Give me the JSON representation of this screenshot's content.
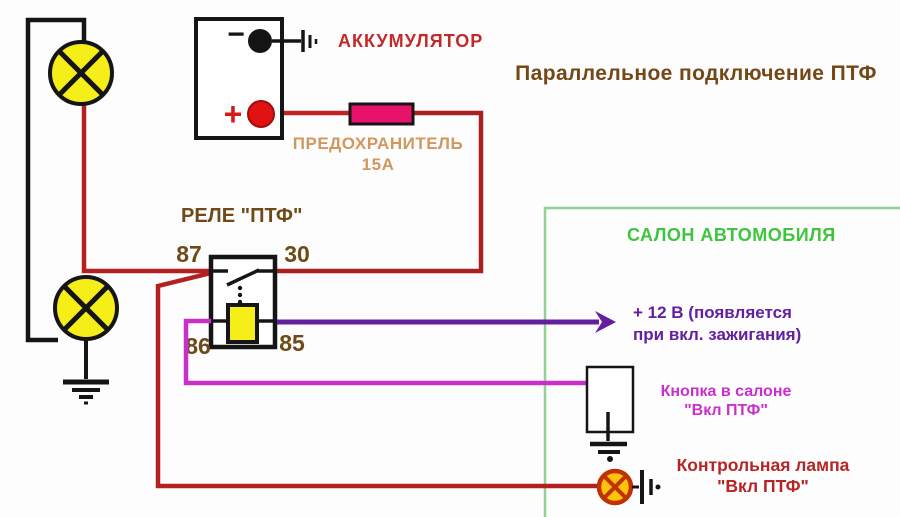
{
  "title": "Параллельное подключение ПТФ",
  "battery": {
    "label": "АККУМУЛЯТОР",
    "minus_sign": "−",
    "plus_sign": "+"
  },
  "fuse": {
    "label": "ПРЕДОХРАНИТЕЛЬ",
    "rating": "15А"
  },
  "relay": {
    "label": "РЕЛЕ \"ПТФ\"",
    "pins": {
      "p87": "87",
      "p30": "30",
      "p86": "86",
      "p85": "85"
    }
  },
  "salon": {
    "label": "САЛОН АВТОМОБИЛЯ"
  },
  "ignition": {
    "line1": "+ 12 В (появляется",
    "line2": "при вкл. зажигания)"
  },
  "button": {
    "line1": "Кнопка в салоне",
    "line2": "\"Вкл ПТФ\""
  },
  "indicator": {
    "line1": "Контрольная лампа",
    "line2": "\"Вкл ПТФ\""
  },
  "colors": {
    "power_wire_red": "#b22020",
    "coil_wire_magenta": "#cb2fcb",
    "ignition_wire_purple": "#641fa0",
    "salon_border_green": "#90d290",
    "salon_text_green": "#3ec43e",
    "fuse_fill": "#e9126b",
    "fog_lamp_yellow": "#f5ee18",
    "indicator_lamp_orange": "#ffc40a",
    "indicator_lamp_border": "#c03000",
    "label_brown": "#754716",
    "label_tan": "#d2975e",
    "label_dark_red": "#b52525"
  }
}
